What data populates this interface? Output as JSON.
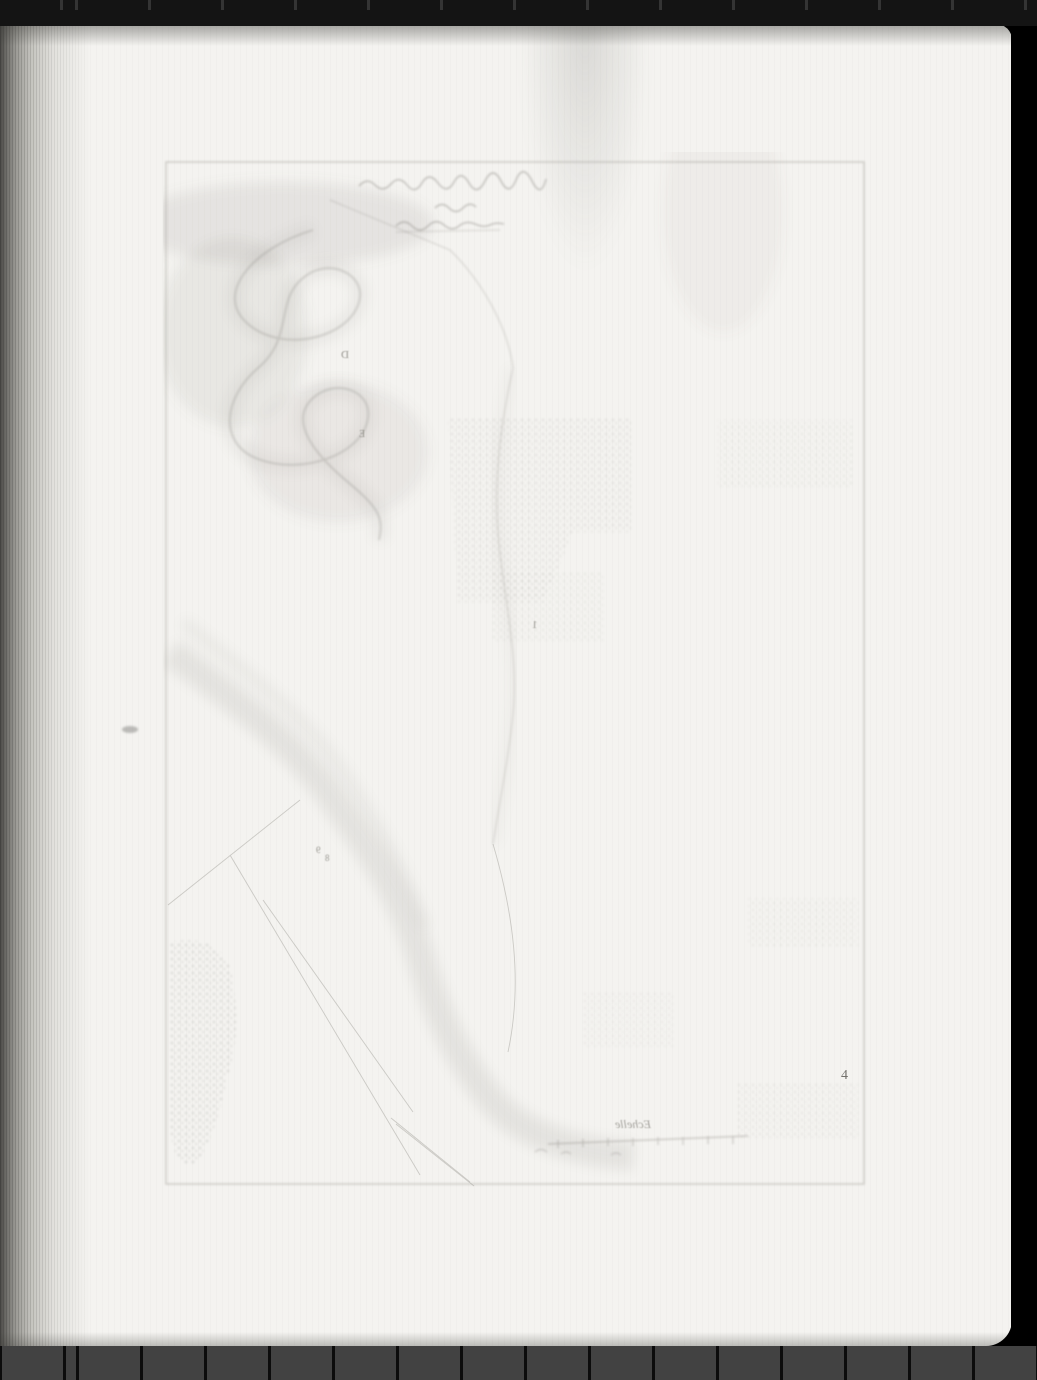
{
  "scan": {
    "description": "Microfilm scan of a book page showing only the faint mirrored bleed-through of an engraved map plate on otherwise blank paper",
    "colors": {
      "background": "#000000",
      "film_strip_top": "#141414",
      "film_strip_top_tick": "#343434",
      "film_strip_bottom": "#424242",
      "film_strip_bottom_tick": "#0c0c0c",
      "paper": "#f4f3f0",
      "spine_shadow": "#4b4a47",
      "plate_ink": "#8e8b84"
    }
  },
  "plate": {
    "number": "4",
    "scale_label": "Echelle",
    "scale_note": "mirrored scale bar near plate bottom, tick numerals illegible",
    "title_note": "three lines of mirrored cursive title at plate top, illegible",
    "letters": [
      {
        "char": "D"
      },
      {
        "char": "E"
      },
      {
        "char": "1"
      },
      {
        "char": "9"
      },
      {
        "char": "8"
      }
    ]
  }
}
